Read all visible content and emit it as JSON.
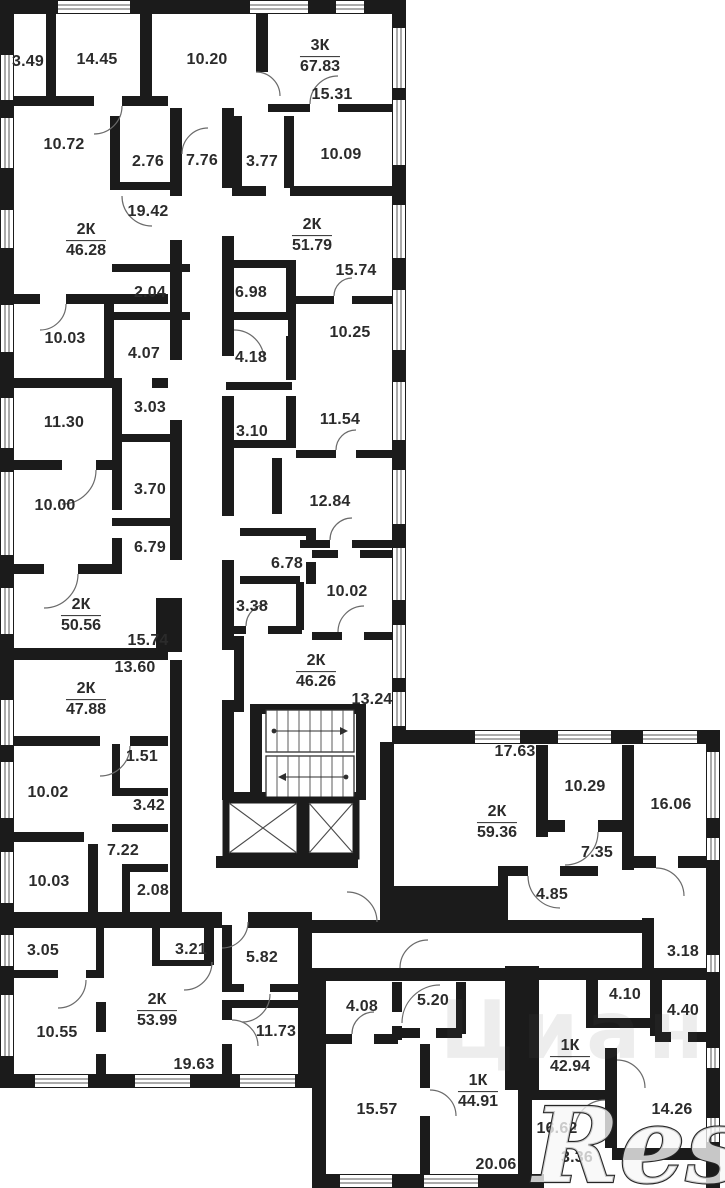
{
  "plan": {
    "colors": {
      "wall": "#1b1b1b",
      "label": "#2b2b2b",
      "background": "#ffffff"
    },
    "watermarks": {
      "primary": "Restate",
      "secondary": "Циан"
    },
    "apartments": [
      {
        "type": "3К",
        "area": "67.83",
        "x": 320,
        "y": 57
      },
      {
        "type": "2К",
        "area": "46.28",
        "x": 86,
        "y": 241
      },
      {
        "type": "2К",
        "area": "51.79",
        "x": 312,
        "y": 236
      },
      {
        "type": "2К",
        "area": "50.56",
        "x": 81,
        "y": 616
      },
      {
        "type": "2К",
        "area": "47.88",
        "x": 86,
        "y": 700
      },
      {
        "type": "2К",
        "area": "46.26",
        "x": 316,
        "y": 672
      },
      {
        "type": "2К",
        "area": "53.99",
        "x": 157,
        "y": 1011
      },
      {
        "type": "2К",
        "area": "59.36",
        "x": 497,
        "y": 823
      },
      {
        "type": "1К",
        "area": "42.94",
        "x": 570,
        "y": 1057
      },
      {
        "type": "1К",
        "area": "44.91",
        "x": 478,
        "y": 1092
      }
    ],
    "rooms": [
      {
        "label": "3.49",
        "x": 28,
        "y": 62
      },
      {
        "label": "14.45",
        "x": 97,
        "y": 60
      },
      {
        "label": "10.20",
        "x": 207,
        "y": 60
      },
      {
        "label": "15.31",
        "x": 332,
        "y": 95
      },
      {
        "label": "10.72",
        "x": 64,
        "y": 145
      },
      {
        "label": "2.76",
        "x": 148,
        "y": 162
      },
      {
        "label": "7.76",
        "x": 202,
        "y": 161
      },
      {
        "label": "3.77",
        "x": 262,
        "y": 162
      },
      {
        "label": "10.09",
        "x": 341,
        "y": 155
      },
      {
        "label": "19.42",
        "x": 148,
        "y": 212
      },
      {
        "label": "2.04",
        "x": 150,
        "y": 293
      },
      {
        "label": "6.98",
        "x": 251,
        "y": 293
      },
      {
        "label": "15.74",
        "x": 356,
        "y": 271
      },
      {
        "label": "10.03",
        "x": 65,
        "y": 339
      },
      {
        "label": "4.07",
        "x": 144,
        "y": 354
      },
      {
        "label": "4.18",
        "x": 251,
        "y": 358
      },
      {
        "label": "10.25",
        "x": 350,
        "y": 333
      },
      {
        "label": "11.30",
        "x": 64,
        "y": 423
      },
      {
        "label": "3.03",
        "x": 150,
        "y": 408
      },
      {
        "label": "3.10",
        "x": 252,
        "y": 432
      },
      {
        "label": "11.54",
        "x": 340,
        "y": 420
      },
      {
        "label": "10.00",
        "x": 55,
        "y": 506
      },
      {
        "label": "3.70",
        "x": 150,
        "y": 490
      },
      {
        "label": "12.84",
        "x": 330,
        "y": 502
      },
      {
        "label": "6.79",
        "x": 150,
        "y": 548
      },
      {
        "label": "6.78",
        "x": 287,
        "y": 564
      },
      {
        "label": "10.02",
        "x": 347,
        "y": 592
      },
      {
        "label": "3.38",
        "x": 252,
        "y": 607
      },
      {
        "label": "15.74",
        "x": 148,
        "y": 641
      },
      {
        "label": "13.60",
        "x": 135,
        "y": 668
      },
      {
        "label": "13.24",
        "x": 372,
        "y": 700
      },
      {
        "label": "1.51",
        "x": 142,
        "y": 757
      },
      {
        "label": "10.02",
        "x": 48,
        "y": 793
      },
      {
        "label": "3.42",
        "x": 149,
        "y": 806
      },
      {
        "label": "7.22",
        "x": 123,
        "y": 851
      },
      {
        "label": "10.03",
        "x": 49,
        "y": 882
      },
      {
        "label": "2.08",
        "x": 153,
        "y": 891
      },
      {
        "label": "3.05",
        "x": 43,
        "y": 951
      },
      {
        "label": "3.21",
        "x": 191,
        "y": 950
      },
      {
        "label": "5.82",
        "x": 262,
        "y": 958
      },
      {
        "label": "10.55",
        "x": 57,
        "y": 1033
      },
      {
        "label": "11.73",
        "x": 276,
        "y": 1032
      },
      {
        "label": "19.63",
        "x": 194,
        "y": 1065
      },
      {
        "label": "17.63",
        "x": 515,
        "y": 752
      },
      {
        "label": "10.29",
        "x": 585,
        "y": 787
      },
      {
        "label": "16.06",
        "x": 671,
        "y": 805
      },
      {
        "label": "7.35",
        "x": 597,
        "y": 853
      },
      {
        "label": "4.85",
        "x": 552,
        "y": 895
      },
      {
        "label": "3.18",
        "x": 683,
        "y": 952
      },
      {
        "label": "4.10",
        "x": 625,
        "y": 995
      },
      {
        "label": "4.40",
        "x": 683,
        "y": 1011
      },
      {
        "label": "16.62",
        "x": 557,
        "y": 1129
      },
      {
        "label": "3.36",
        "x": 577,
        "y": 1158
      },
      {
        "label": "14.26",
        "x": 672,
        "y": 1110
      },
      {
        "label": "4.08",
        "x": 362,
        "y": 1007
      },
      {
        "label": "5.20",
        "x": 433,
        "y": 1001
      },
      {
        "label": "15.57",
        "x": 377,
        "y": 1110
      },
      {
        "label": "20.06",
        "x": 496,
        "y": 1165
      }
    ]
  }
}
